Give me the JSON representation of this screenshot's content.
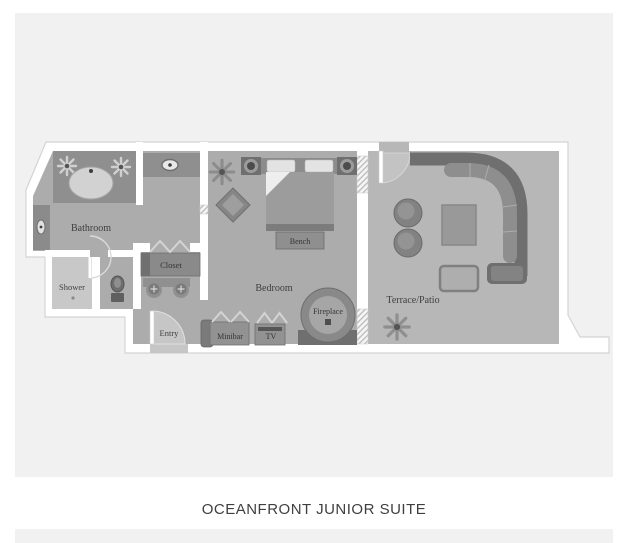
{
  "title": "OCEANFRONT JUNIOR SUITE",
  "plan": {
    "labels": {
      "bathroom": "Bathroom",
      "shower": "Shower",
      "closet": "Closet",
      "entry": "Entry",
      "minibar": "Minibar",
      "tv": "TV",
      "bedroom": "Bedroom",
      "bench": "Bench",
      "fireplace": "Fireplace",
      "terrace": "Terrace/Patio"
    }
  },
  "colors": {
    "card_background": "#f1f1f1",
    "wall": "#ffffff",
    "wall_outline": "#d4d4d4",
    "floor": "#acacac",
    "terrace_floor": "#b7b7b7",
    "furniture_dark": "#6f6f6f",
    "furniture_mid": "#8f8f8f",
    "fixture_light": "#d2d2d2",
    "label_text": "#3f3f3f",
    "title_text": "#3f3f3f"
  }
}
